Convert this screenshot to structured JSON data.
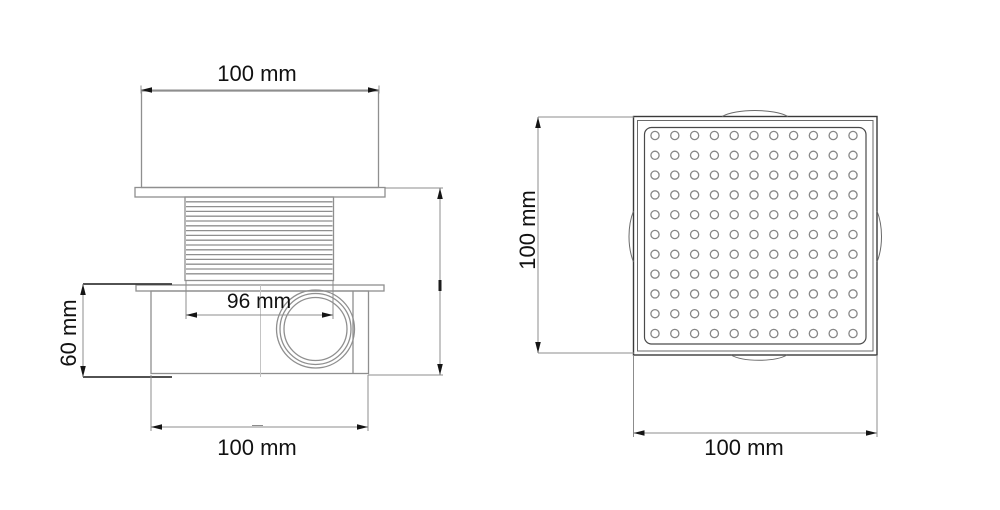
{
  "colors": {
    "background": "#ffffff",
    "object_line": "#8f8f8f",
    "frame_line": "#3a3a3a",
    "dimension_line": "#8c8c8c",
    "text": "#111111"
  },
  "side_view": {
    "dim_top_width": "100 mm",
    "dim_riser_width": "96 mm",
    "dim_height": "60 mm",
    "dim_bottom_width": "100 mm"
  },
  "top_view": {
    "dim_height": "100 mm",
    "dim_width": "100 mm",
    "grate": {
      "rows": 11,
      "cols": 11,
      "hole_shape": "circle"
    }
  }
}
